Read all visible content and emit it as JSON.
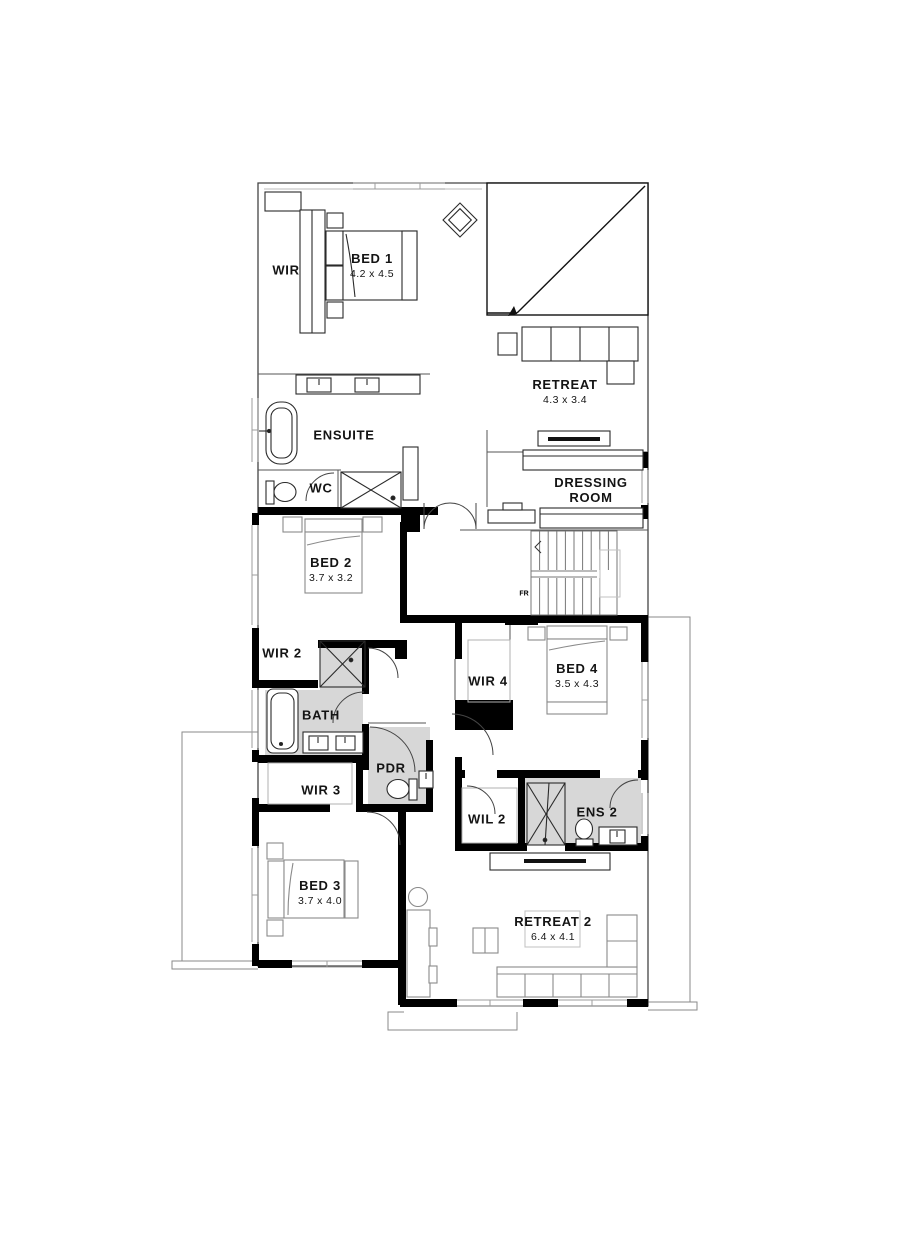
{
  "figure": "upper floor plan",
  "rooms": {
    "wir": {
      "label": "WIR"
    },
    "bed1": {
      "label": "BED 1",
      "dims": "4.2 x 4.5"
    },
    "retreat": {
      "label": "RETREAT",
      "dims": "4.3 x 3.4"
    },
    "ensuite": {
      "label": "ENSUITE"
    },
    "wc": {
      "label": "WC"
    },
    "dressing": {
      "label": "DRESSING",
      "label2": "ROOM"
    },
    "bed2": {
      "label": "BED 2",
      "dims": "3.7 x 3.2"
    },
    "wir2": {
      "label": "WIR 2"
    },
    "bath": {
      "label": "BATH"
    },
    "pdr": {
      "label": "PDR"
    },
    "wir3": {
      "label": "WIR 3"
    },
    "wir4": {
      "label": "WIR 4"
    },
    "bed4": {
      "label": "BED 4",
      "dims": "3.5 x 4.3"
    },
    "wil2": {
      "label": "WIL 2"
    },
    "ens2": {
      "label": "ENS 2"
    },
    "bed3": {
      "label": "BED 3",
      "dims": "3.7 x 4.0"
    },
    "retreat2": {
      "label": "RETREAT 2",
      "dims": "6.4 x 4.1"
    },
    "stair_note": {
      "label": "FR"
    }
  },
  "colors": {
    "wall": "#000000",
    "wet_area_floor": "#d7d7d7",
    "outline": "#555555",
    "window": "#9c9c9c",
    "furniture": "#3a3a3a"
  }
}
